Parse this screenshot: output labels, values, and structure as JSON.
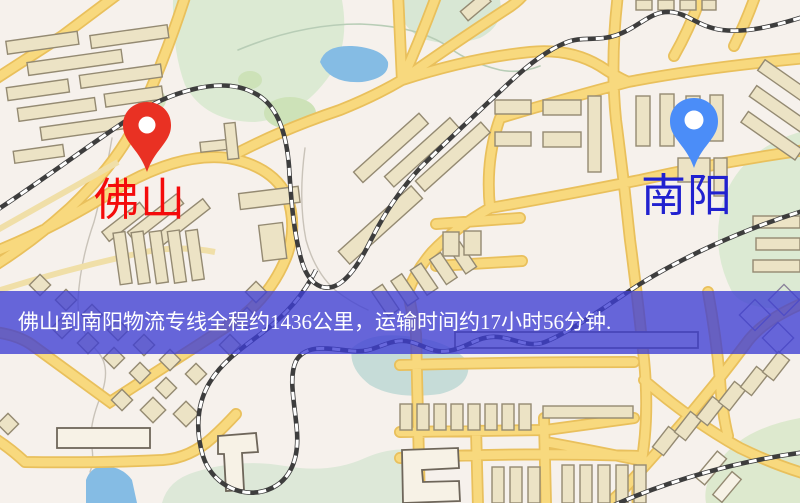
{
  "banner": {
    "text": "佛山到南阳物流专线全程约1436公里，运输时间约17小时56分钟.",
    "background_color": "#3e3ed4",
    "text_color": "#ffffff"
  },
  "route": {
    "origin": "佛山",
    "destination": "南阳",
    "distance_text": "约1436公里",
    "duration_text": "约17小时56分钟"
  },
  "markers": {
    "origin": {
      "label": "佛山",
      "pin_color": "#e93123",
      "label_color": "#f40b0b"
    },
    "destination": {
      "label": "南阳",
      "pin_color": "#4b8df8",
      "label_color": "#2121cf"
    }
  },
  "map": {
    "colors": {
      "background": "#f6f1ec",
      "road_fill": "#f8d97e",
      "road_casing": "#e9c05c",
      "minor_road": "#f0dfa8",
      "park": "#dcead3",
      "park_dark": "#cde2b8",
      "water": "#85bce4",
      "water_pale": "#c6dcd8",
      "building": "#ece3c5",
      "building_outline": "#948a72",
      "railway": "#3d3d3d"
    }
  }
}
